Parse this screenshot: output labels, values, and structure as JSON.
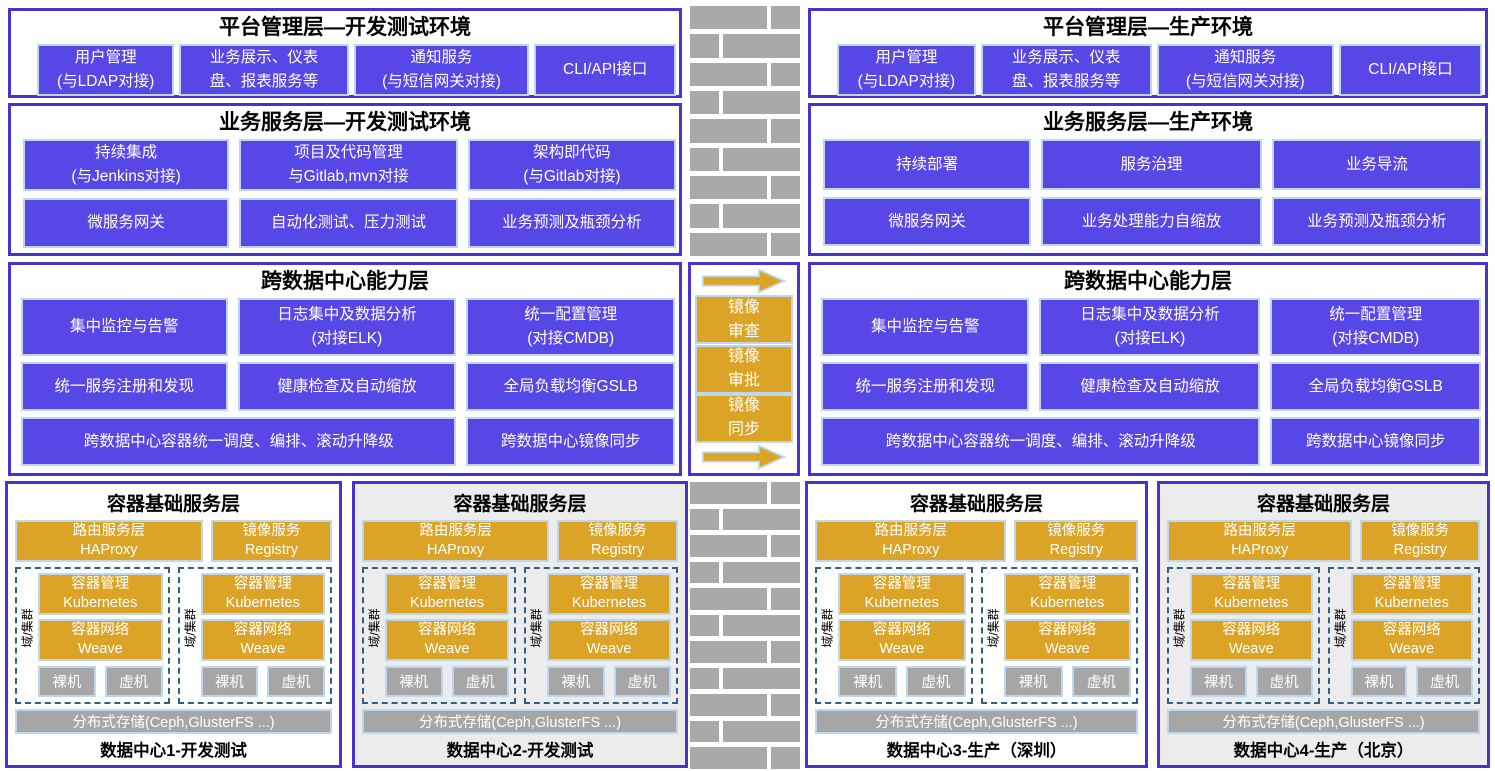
{
  "colors": {
    "purple": "#5747e6",
    "purpleBorder": "#4733d4",
    "lightblue": "#bdd7ee",
    "gold": "#dba426",
    "grayBox": "#a6a6a6",
    "brick": "#a9a9a9",
    "dash": "#2f5f87"
  },
  "left": {
    "platform": {
      "title": "平台管理层—开发测试环境",
      "boxes": [
        "用户管理\n(与LDAP对接)",
        "业务展示、仪表\n盘、报表服务等",
        "通知服务\n(与短信网关对接)",
        "CLI/API接口"
      ]
    },
    "business": {
      "title": "业务服务层—开发测试环境",
      "row1": [
        "持续集成\n(与Jenkins对接)",
        "项目及代码管理\n与Gitlab,mvn对接",
        "架构即代码\n(与Gitlab对接)"
      ],
      "row2": [
        "微服务网关",
        "自动化测试、压力测试",
        "业务预测及瓶颈分析"
      ]
    },
    "crossdc": {
      "title": "跨数据中心能力层",
      "row1": [
        "集中监控与告警",
        "日志集中及数据分析\n(对接ELK)",
        "统一配置管理\n(对接CMDB)"
      ],
      "row2": [
        "统一服务注册和发现",
        "健康检查及自动缩放",
        "全局负载均衡GSLB"
      ],
      "row3": [
        "跨数据中心容器统一调度、编排、滚动升降级",
        "跨数据中心镜像同步"
      ]
    }
  },
  "right": {
    "platform": {
      "title": "平台管理层—生产环境",
      "boxes": [
        "用户管理\n(与LDAP对接)",
        "业务展示、仪表\n盘、报表服务等",
        "通知服务\n(与短信网关对接)",
        "CLI/API接口"
      ]
    },
    "business": {
      "title": "业务服务层—生产环境",
      "row1": [
        "持续部署",
        "服务治理",
        "业务导流"
      ],
      "row2": [
        "微服务网关",
        "业务处理能力自缩放",
        "业务预测及瓶颈分析"
      ]
    },
    "crossdc": {
      "title": "跨数据中心能力层",
      "row1": [
        "集中监控与告警",
        "日志集中及数据分析\n(对接ELK)",
        "统一配置管理\n(对接CMDB)"
      ],
      "row2": [
        "统一服务注册和发现",
        "健康检查及自动缩放",
        "全局负载均衡GSLB"
      ],
      "row3": [
        "跨数据中心容器统一调度、编排、滚动升降级",
        "跨数据中心镜像同步"
      ]
    }
  },
  "mirror": {
    "steps": [
      "镜像\n审查",
      "镜像\n审批",
      "镜像\n同步"
    ]
  },
  "dc": {
    "title": "容器基础服务层",
    "routing": "路由服务层\nHAProxy",
    "registry": "镜像服务\nRegistry",
    "cluster_label": "域/集群",
    "k8s": "容器管理\nKubernetes",
    "network": "容器网络\nWeave",
    "bare_metal": "裸机",
    "vm": "虚机",
    "storage": "分布式存储(Ceph,GlusterFS ...)",
    "footers": [
      "数据中心1-开发测试",
      "数据中心2-开发测试",
      "数据中心3-生产（深圳）",
      "数据中心4-生产（北京）"
    ]
  }
}
